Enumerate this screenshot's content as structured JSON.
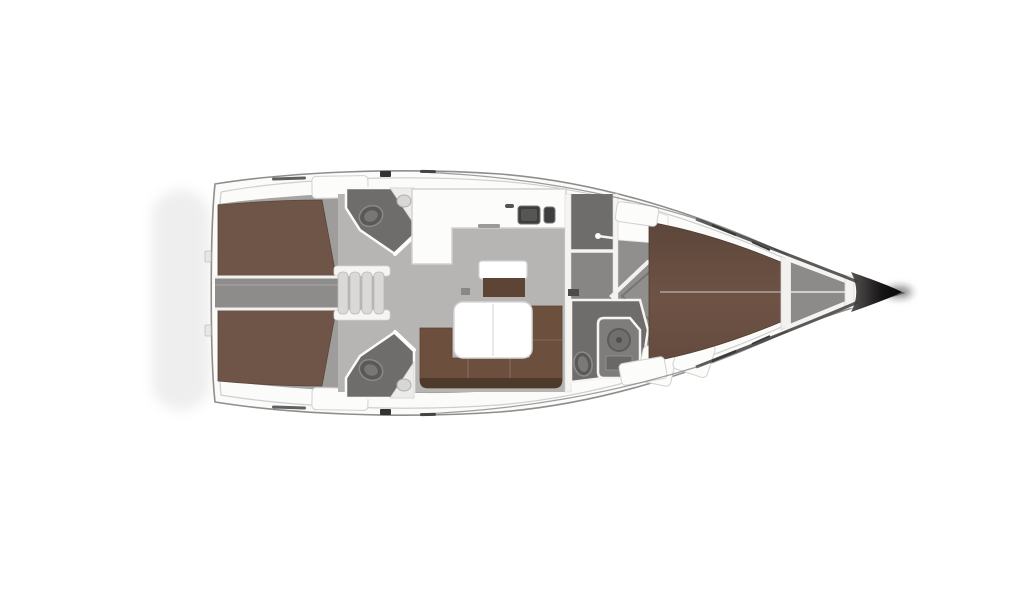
{
  "figure": {
    "type": "floor-plan",
    "subject": "sailing-yacht interior deck plan, top view, bow pointing right",
    "orientation": "horizontal",
    "visible_text": "none"
  },
  "parts": [
    {
      "id": "hull",
      "name": "hull-outline"
    },
    {
      "id": "aft-cabin-port",
      "name": "aft-double-berth-top"
    },
    {
      "id": "aft-cabin-stbd",
      "name": "aft-double-berth-bottom"
    },
    {
      "id": "corridor",
      "name": "engine-corridor"
    },
    {
      "id": "steps",
      "name": "companionway-steps"
    },
    {
      "id": "head-aft-port",
      "name": "aft-bathroom-top"
    },
    {
      "id": "head-aft-stbd",
      "name": "aft-bathroom-bottom"
    },
    {
      "id": "galley",
      "name": "l-shaped-galley-with-double-sink"
    },
    {
      "id": "salon",
      "name": "salon-with-u-sofa-and-table"
    },
    {
      "id": "sideboard",
      "name": "salon-sideboard"
    },
    {
      "id": "head-fwd",
      "name": "forward-bathroom-with-shower"
    },
    {
      "id": "fwd-cabin",
      "name": "forward-v-berth-cabin"
    },
    {
      "id": "anchor-locker",
      "name": "anchor-locker"
    },
    {
      "id": "bow",
      "name": "bow-tip"
    }
  ],
  "colors": {
    "background": "#ffffff",
    "hull_fill": "#fbfbfa",
    "hull_stroke": "#8f8e8d",
    "inner_deck_line": "#cfcecd",
    "sheer_dark": "#3f3e3d",
    "interior_base": "#a5a4a3",
    "salon_floor": "#b6b5b3",
    "cabin_floor": "#9e9d9c",
    "corridor": "#8d8c8b",
    "passage": "#878685",
    "head_room": "#6e6d6c",
    "white_furniture": "#fcfcfb",
    "furniture_stroke": "#d2d1d0",
    "wall_white": "#f5f4f3",
    "berth_aft": "#6f5547",
    "berth_fwd_top": "#5c463a",
    "berth_fwd_mid": "#6e5345",
    "berth_fwd_bottom": "#644b3e",
    "sofa": "#6c4f3d",
    "sofa_shadow": "#4e3a2c",
    "sideboard_brown": "#5e4435",
    "table_fill": "#ffffff",
    "table_stroke": "#d8d7d6",
    "sink_dark": "#3e3e3e",
    "steps_fill": "#dad9d7",
    "toilet_fill": "#5a5958",
    "shower_fill": "#7e7d7c",
    "anchor_locker": "#8c8b8a",
    "bow_dark_start": "#555453",
    "bow_dark_end": "#000000",
    "shadow": "#9a9a9a",
    "hatch_dark": "#3a3a3a"
  }
}
